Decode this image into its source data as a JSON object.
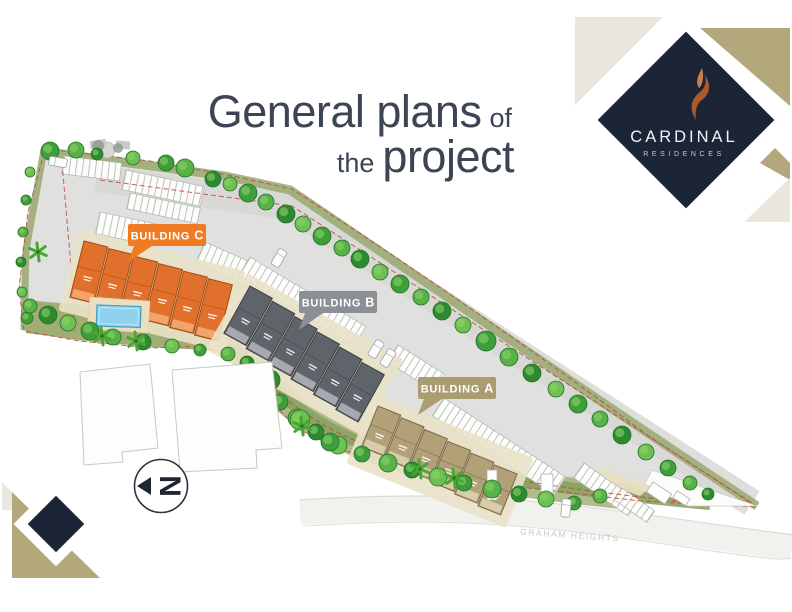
{
  "title": {
    "line1_big": "General plans",
    "line1_small": "of",
    "line2_small": "the",
    "line2_big": "project"
  },
  "logo": {
    "brand": "CARDINAL",
    "subtitle": "RESIDENCES",
    "diamond_color": "#1c2437",
    "tan_color": "#b2a87c",
    "beige_color": "#e9e6de",
    "flame_color": "#c9804f",
    "flame_dark": "#a95b2c"
  },
  "site_plan": {
    "buildings": [
      {
        "letter": "C",
        "label_prefix": "BUILDING",
        "label_bg": "#ef7c24",
        "roof": "#e0702c",
        "roof_edge": "#a34d10",
        "wall": "#f2a56b",
        "divider": "#c05813"
      },
      {
        "letter": "B",
        "label_prefix": "BUILDING",
        "label_bg": "#8b8f96",
        "roof": "#5f636a",
        "roof_edge": "#3b3e44",
        "wall": "#a6a9af",
        "divider": "#4a4d53"
      },
      {
        "letter": "A",
        "label_prefix": "BUILDING",
        "label_bg": "#ab9d72",
        "roof": "#b2a077",
        "roof_edge": "#77684a",
        "wall": "#d8cda9",
        "divider": "#8a7a54"
      }
    ],
    "street_label": "GRAHAM HEIGHTS",
    "compass_letter": "N",
    "boundary_color": "#c2463c",
    "pool_color": "#8fd2ef",
    "landscape_color": "#9dab74",
    "paving_color": "#e0e0de"
  }
}
